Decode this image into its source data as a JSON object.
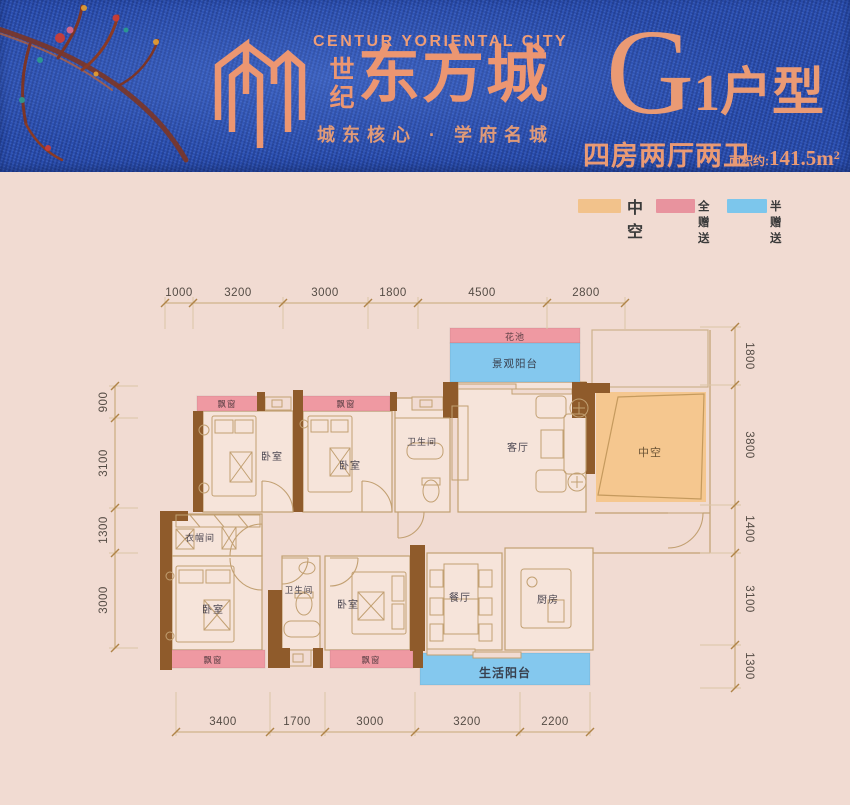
{
  "header": {
    "brand_en": "CENTUR YORIENTAL CITY",
    "brand_cn_small_1": "世",
    "brand_cn_small_2": "纪",
    "brand_cn_large": "东方城",
    "tagline": "城东核心 · 学府名城",
    "unit_letter": "G",
    "unit_suffix": "1户型",
    "unit_desc": "四房两厅两卫",
    "area_label": "面积约:",
    "area_value": "141.5m",
    "area_sup": "2"
  },
  "colors": {
    "header_bg": "#2a4eb0",
    "accent_salmon": "#ec9671",
    "body_bg": "#f1dbd2",
    "hollow_orange": "#f5c78f",
    "gift_pink": "#ef99a2",
    "half_gift_blue": "#84c8ee",
    "wall_brown": "#8f5b2b",
    "line_tan": "#c2a072"
  },
  "legend": {
    "items": [
      {
        "label": "中空",
        "color": "#f2c28b"
      },
      {
        "label": "全赠送",
        "color": "#e8939e"
      },
      {
        "label": "半赠送",
        "color": "#7cc6ec"
      }
    ]
  },
  "floorplan": {
    "rooms": {
      "bedroom": "卧室",
      "bathroom": "卫生间",
      "living": "客厅",
      "dining": "餐厅",
      "kitchen": "厨房",
      "cloakroom": "衣帽间",
      "hollow": "中空",
      "flower_bed": "花池",
      "view_balcony": "景观阳台",
      "life_balcony": "生活阳台",
      "bay_window": "飘窗"
    },
    "dims": {
      "top": [
        "1000",
        "3200",
        "3000",
        "1800",
        "4500",
        "2800"
      ],
      "bottom": [
        "3400",
        "1700",
        "3000",
        "3200",
        "2200"
      ],
      "left": [
        "900",
        "3100",
        "1300",
        "3000"
      ],
      "right": [
        "1800",
        "3800",
        "1400",
        "3100",
        "1300"
      ]
    }
  }
}
